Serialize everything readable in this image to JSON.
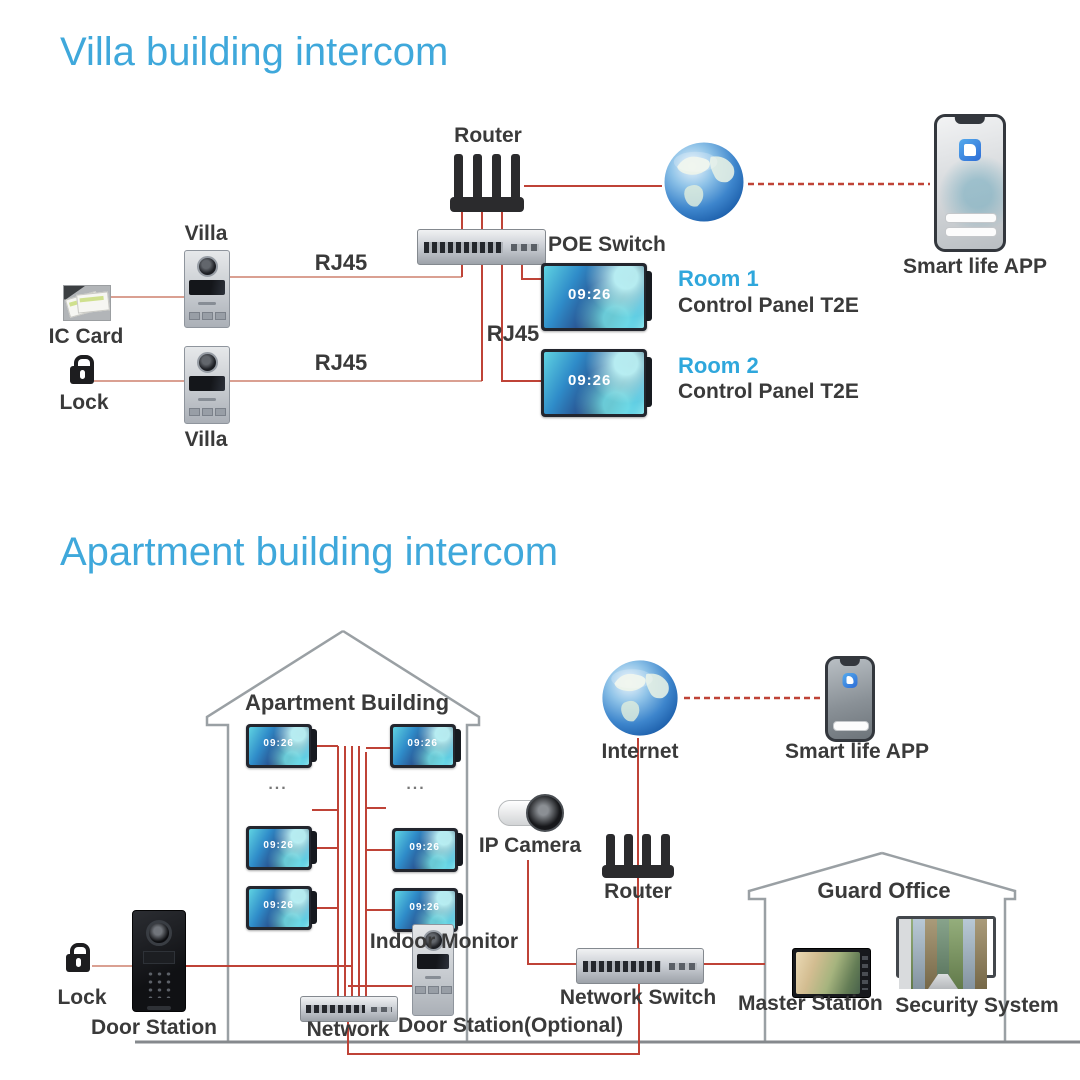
{
  "villa": {
    "title": "Villa building intercom",
    "router_label": "Router",
    "poe_switch_label": "POE Switch",
    "app_label": "Smart life APP",
    "ic_card_label": "IC Card",
    "lock_label": "Lock",
    "rj45_labels": [
      "RJ45",
      "RJ45",
      "RJ45"
    ],
    "door_stations": [
      {
        "label": "Villa"
      },
      {
        "label": "Villa"
      }
    ],
    "rooms": [
      {
        "name": "Room 1",
        "device": "Control Panel T2E",
        "clock": "09:26"
      },
      {
        "name": "Room 2",
        "device": "Control Panel T2E",
        "clock": "09:26"
      }
    ]
  },
  "apartment": {
    "title": "Apartment building intercom",
    "building_label": "Apartment Building",
    "monitor_clock": "09:26",
    "dots": "...",
    "indoor_monitor_label": "Indoor Monitor",
    "internet_label": "Internet",
    "app_label": "Smart life APP",
    "ip_camera_label": "IP Camera",
    "router_label": "Router",
    "network_switch_label": "Network Switch",
    "network_label": "Network",
    "door_station_label": "Door Station",
    "door_station_optional_label": "Door Station(Optional)",
    "lock_label": "Lock",
    "guard_office": {
      "label": "Guard Office",
      "master_station_label": "Master Station",
      "security_system_label": "Security System"
    }
  },
  "colors": {
    "accent_blue": "#3fa8db",
    "room_blue": "#2fa7dc",
    "line_red": "#bf4337",
    "line_salmon": "#daa092",
    "outline_gray": "#9aa0a4",
    "clock_text": "#ffffff"
  }
}
